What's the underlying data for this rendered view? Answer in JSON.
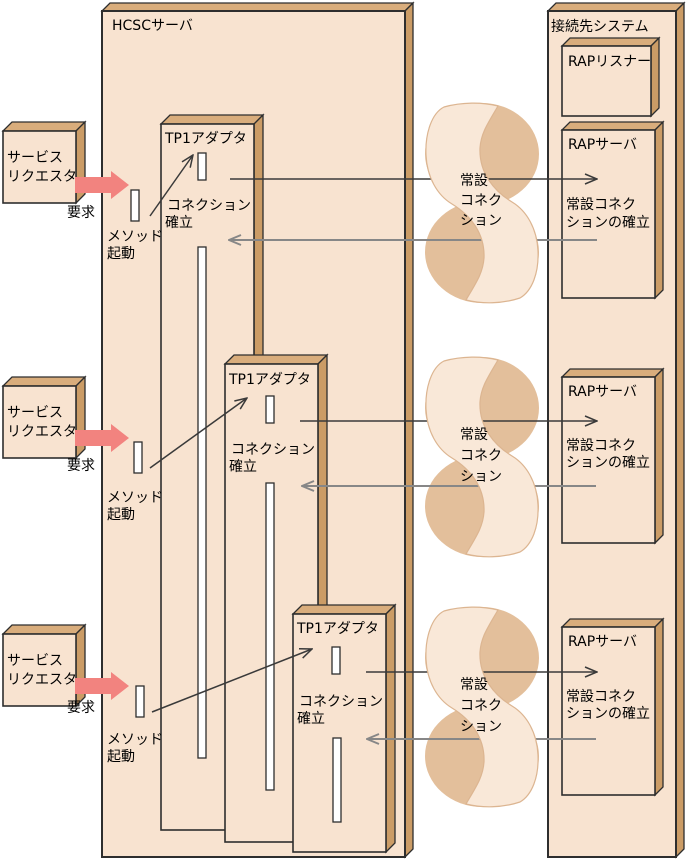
{
  "canvas": {
    "width": 687,
    "height": 863
  },
  "hcsc_server": {
    "title": "HCSCサーバ"
  },
  "destination_system": {
    "title": "接続先システム",
    "rap_listener_label": "RAPリスナー"
  },
  "rows": [
    {
      "requester": {
        "line1": "サービス",
        "line2": "リクエスタ"
      },
      "request_label": "要求",
      "method_label": {
        "line1": "メソッド",
        "line2": "起動"
      },
      "adapter_label": "TP1アダプタ",
      "connection_label": {
        "line1": "コネクション",
        "line2": "確立"
      },
      "channel_label": {
        "line1": "常設",
        "line2": "コネク",
        "line3": "ション"
      },
      "rap_server_label": "RAPサーバ",
      "establish_label": {
        "line1": "常設コネク",
        "line2": "ションの確立"
      }
    },
    {
      "requester": {
        "line1": "サービス",
        "line2": "リクエスタ"
      },
      "request_label": "要求",
      "method_label": {
        "line1": "メソッド",
        "line2": "起動"
      },
      "adapter_label": "TP1アダプタ",
      "connection_label": {
        "line1": "コネクション",
        "line2": "確立"
      },
      "channel_label": {
        "line1": "常設",
        "line2": "コネク",
        "line3": "ション"
      },
      "rap_server_label": "RAPサーバ",
      "establish_label": {
        "line1": "常設コネク",
        "line2": "ションの確立"
      }
    },
    {
      "requester": {
        "line1": "サービス",
        "line2": "リクエスタ"
      },
      "request_label": "要求",
      "method_label": {
        "line1": "メソッド",
        "line2": "起動"
      },
      "adapter_label": "TP1アダプタ",
      "connection_label": {
        "line1": "コネクション",
        "line2": "確立"
      },
      "channel_label": {
        "line1": "常設",
        "line2": "コネク",
        "line3": "ション"
      },
      "rap_server_label": "RAPサーバ",
      "establish_label": {
        "line1": "常設コネク",
        "line2": "ションの確立"
      }
    }
  ],
  "colors": {
    "front": "#f8e3d0",
    "bevel_top": "#d9ad7c",
    "bevel_side": "#cb9c66",
    "outline": "#2e2e2e",
    "slot": "#ffffff",
    "band": "#f9e8d8",
    "band_edge": "#dcb591",
    "lobe": "#e3bf9b",
    "arrow_dark": "#3a3a3a",
    "arrow_gray": "#878787",
    "pink": "#f2837f"
  }
}
